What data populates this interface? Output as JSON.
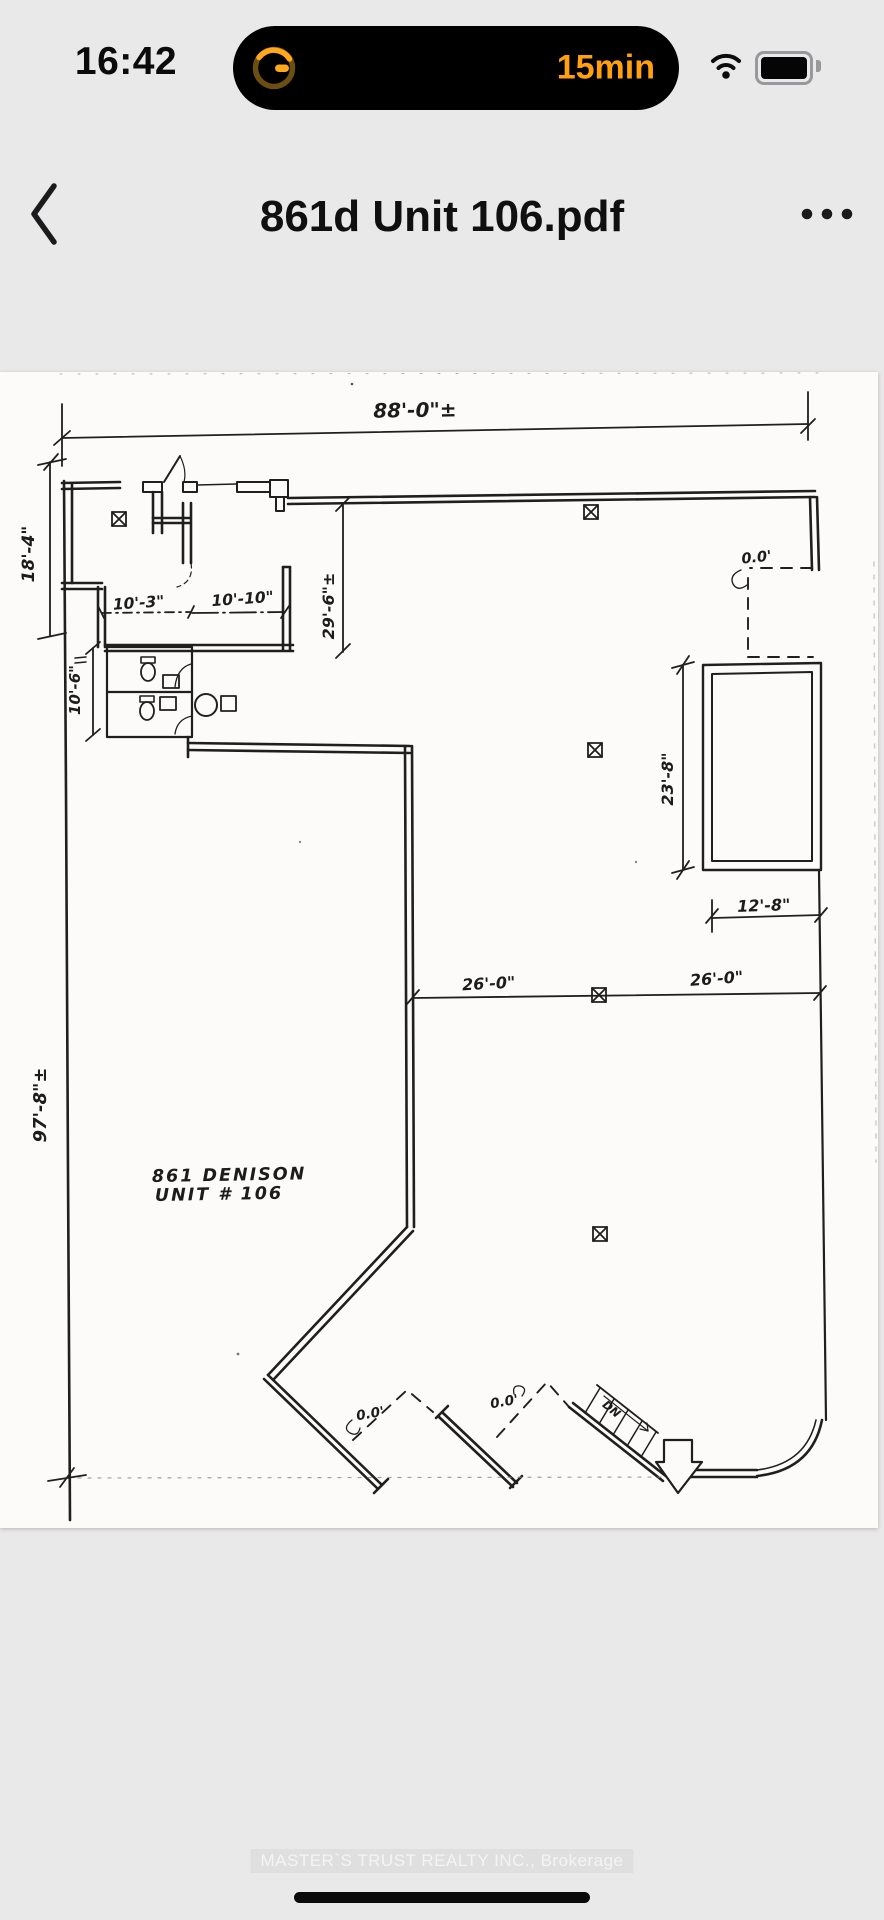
{
  "status_bar": {
    "time": "16:42",
    "timer_pill": {
      "icon": "timer-ring-icon",
      "remaining_label": "15min",
      "accent_color": "#FFA00D",
      "pill_color": "#000000"
    },
    "wifi_icon": "wifi-icon",
    "battery_icon": "battery-icon"
  },
  "nav_bar": {
    "back_icon": "chevron-left-icon",
    "title": "861d Unit 106.pdf",
    "more_icon": "ellipsis-icon"
  },
  "document": {
    "page_color": "#fcfbfa",
    "ink_color": "#1f1f1f",
    "floor_plan": {
      "dimensions": {
        "overall_width": "88'-0\"±",
        "upper_left_height": "18'-4\"",
        "overall_height": "97'-8\"±",
        "corridor_depth": "29'-6\"±",
        "room_a_width": "10'-3\"",
        "room_b_width": "10'-10\"",
        "washroom_height": "10'-6\"",
        "right_room_height": "23'-8\"",
        "right_room_width": "12'-8\"",
        "mid_span_left": "26'-0\"",
        "mid_span_right": "26'-0\""
      },
      "labels": {
        "address_line1": "861 DENISON",
        "address_line2": "UNIT # 106",
        "elevation_top_right": "0.0'",
        "elevation_bottom_left": "0.0'",
        "elevation_bottom_mid": "0.0'",
        "stair_direction": "DN"
      }
    }
  },
  "footer": {
    "watermark": "MASTER`S TRUST REALTY INC., Brokerage"
  }
}
